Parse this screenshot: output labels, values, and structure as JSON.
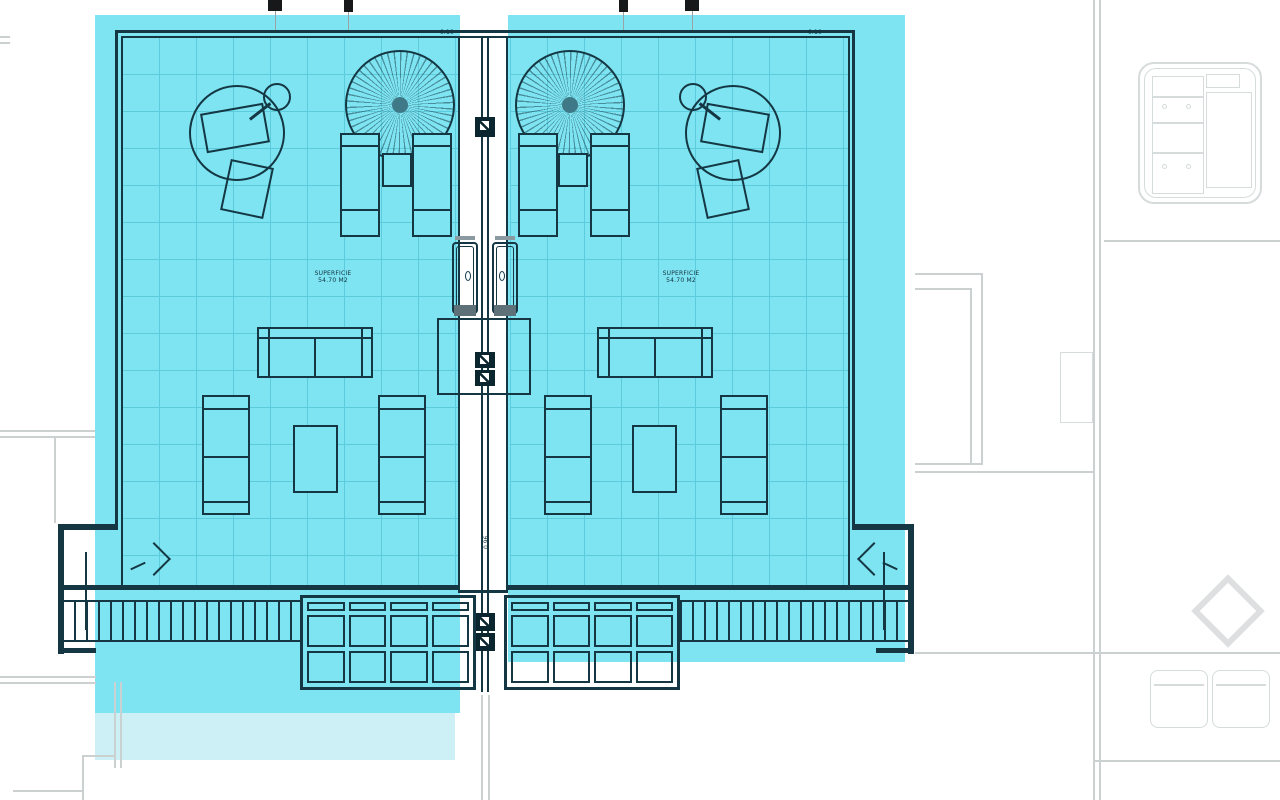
{
  "plan": {
    "dimensions": {
      "top_left_width": "6.10",
      "top_right_width": "6.10",
      "corridor_width": "0.96"
    },
    "units": {
      "left": {
        "area_label_line1": "SUPERFICIE",
        "area_label_line2": "54.70 M2"
      },
      "right": {
        "area_label_line1": "SUPERFICIE",
        "area_label_line2": "54.70 M2"
      }
    },
    "colors": {
      "highlight_cyan": "#7ee4f2",
      "highlight_cyan_soft": "#cdeff6",
      "tile_grid_line": "#5cccdc",
      "plan_line_dark": "#143743",
      "context_line_gray": "#cbd0d1"
    }
  }
}
